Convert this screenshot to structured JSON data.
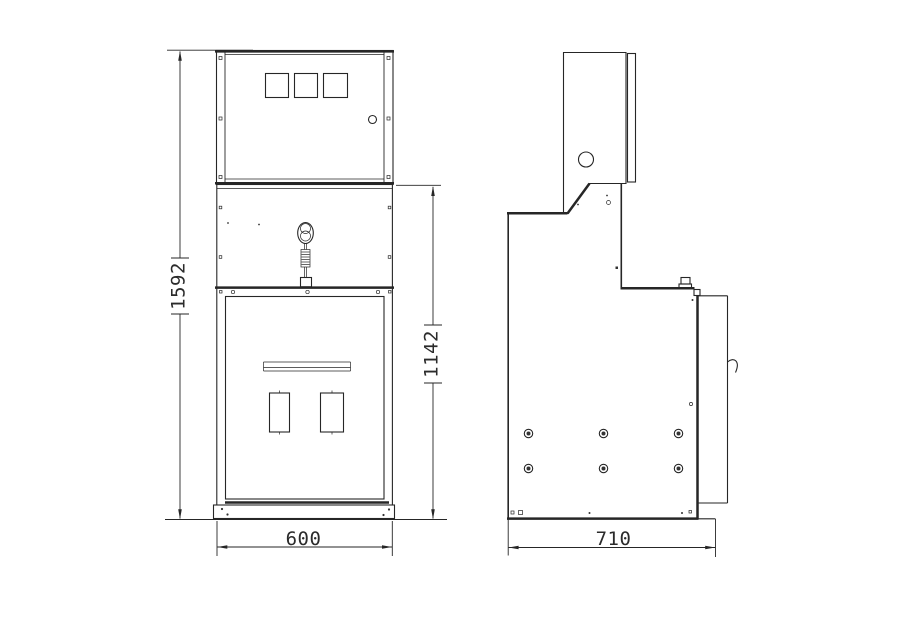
{
  "document": {
    "type": "technical outline drawing, switchgear cabinet, front and side views",
    "background": "#ffffff",
    "line_color": "#262626"
  },
  "dimensions": {
    "overall_height": {
      "value": "1592",
      "orientation": "vertical",
      "view": "front-left"
    },
    "lower_section_height": {
      "value": "1142",
      "orientation": "vertical",
      "view": "front-right"
    },
    "front_width": {
      "value": "600",
      "orientation": "horizontal",
      "view": "front-bottom"
    },
    "side_depth": {
      "value": "710",
      "orientation": "horizontal",
      "view": "side-bottom"
    }
  }
}
